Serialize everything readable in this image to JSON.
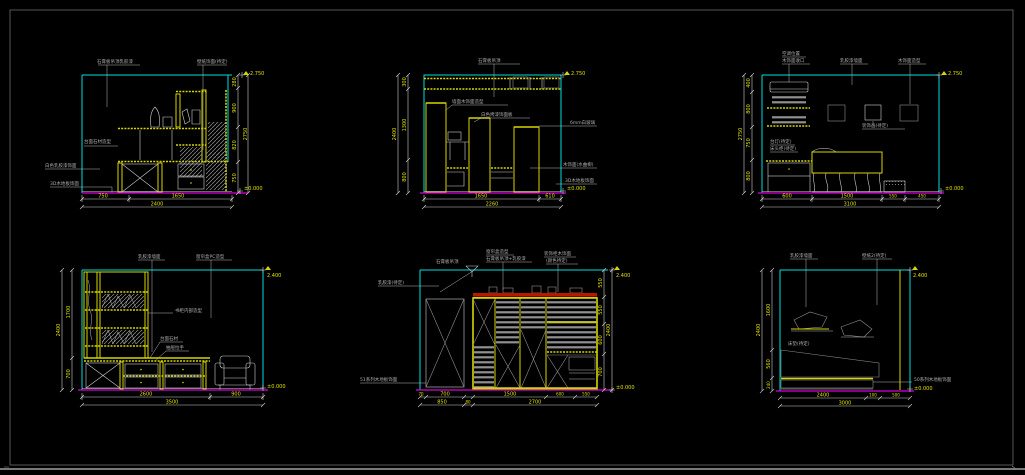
{
  "colors": {
    "background": "#000000",
    "sheet_frame": "#8c8c8c",
    "wall_ceiling_lines": "#00dede",
    "furniture_lines": "#d6d600",
    "floor_line": "#d800d8",
    "dimension_text": "#e0e000",
    "annotation_text": "#aeaeae",
    "accent_band": "#b81800",
    "hatch": "#8f8f8f"
  },
  "views": {
    "v1": {
      "labels": {
        "ceiling": "石膏板吊顶乳胶漆",
        "wall": "壁纸饰面(待定)",
        "desk": "台面石材造型",
        "paint": "白色乳胶漆饰面",
        "floor": "3D木地板饰面"
      },
      "dims": {
        "bottom": [
          "750",
          "1650"
        ],
        "bottom_total": "2400",
        "right": [
          "280",
          "900",
          "820",
          "750"
        ],
        "right_total": "2750"
      },
      "elevation": {
        "top": "2.750",
        "bottom": "±0.000"
      }
    },
    "v2": {
      "labels": {
        "ceiling": "石膏板吊顶",
        "panel1": "墙面木饰面造型",
        "panel2": "白色烤漆饰面板",
        "right1": "6mm白玻璃",
        "right2": "木饰面(水曲柳)",
        "right3": "3D木地板饰面"
      },
      "dims": {
        "left": [
          "300",
          "1300",
          "800"
        ],
        "left_total": "2400",
        "bottom": [
          "1650",
          "610"
        ],
        "bottom_total": "2260"
      },
      "elevation": {
        "top": "2.750",
        "bottom": "±0.000"
      }
    },
    "v3": {
      "labels": {
        "ac1": "空调位置",
        "ac2": "木饰面收口",
        "wall": "乳胶漆墙面",
        "deco": "木饰面造型",
        "picture": "装饰画(待定)",
        "lamp": "台灯(待定)",
        "nightstand": "床头柜(待定)"
      },
      "dims": {
        "left": [
          "400",
          "800",
          "750",
          "800"
        ],
        "left_total": "2750",
        "bottom": [
          "600",
          "1500",
          "550",
          "450"
        ],
        "bottom_total": "3100"
      },
      "elevation": {
        "top": "2.750",
        "bottom": "±0.000"
      }
    },
    "v4": {
      "labels": {
        "wall": "乳胶漆墙面",
        "curtain": "窗帘盒PC造型",
        "shelf": "书柜内部造型",
        "counter": "台面石材",
        "drawer": "抽屉拉手"
      },
      "dims": {
        "left": [
          "1700",
          "700"
        ],
        "left_total": "2400",
        "bottom": [
          "2600",
          "900"
        ],
        "bottom_total": "3500"
      },
      "elevation": {
        "top": "2.400",
        "bottom": "±0.000"
      }
    },
    "v5": {
      "labels": {
        "ceiling_left": "石膏板吊顶",
        "top1a": "窗帘盒造型",
        "top1b": "石膏板吊顶+乳胶漆",
        "top2a": "装饰柜木饰面",
        "top2b": "(颜色待定)",
        "wall_left": "乳胶漆(待定)",
        "floor": "51系列木地板饰面"
      },
      "dims": {
        "bottom1": [
          "70",
          "700",
          "1500",
          "600",
          "550"
        ],
        "bottom2": [
          "850",
          "80",
          "2700"
        ],
        "right": [
          "550",
          "550",
          "600",
          "700"
        ],
        "right_total": "2400"
      },
      "elevation": {
        "top": "2.400",
        "bottom": "±0.000"
      }
    },
    "v6": {
      "labels": {
        "wall": "乳胶漆墙面",
        "wallpaper": "壁纸2(待定)",
        "mattress": "床垫(待定)",
        "floor": "50系列木地板饰面"
      },
      "dims": {
        "left": [
          "1600",
          "560",
          "240"
        ],
        "left_total": "2400",
        "bottom": [
          "2400",
          "100",
          "500"
        ],
        "bottom_total": "3000"
      },
      "elevation": {
        "top": "2.400",
        "bottom": "±0.000"
      }
    }
  }
}
